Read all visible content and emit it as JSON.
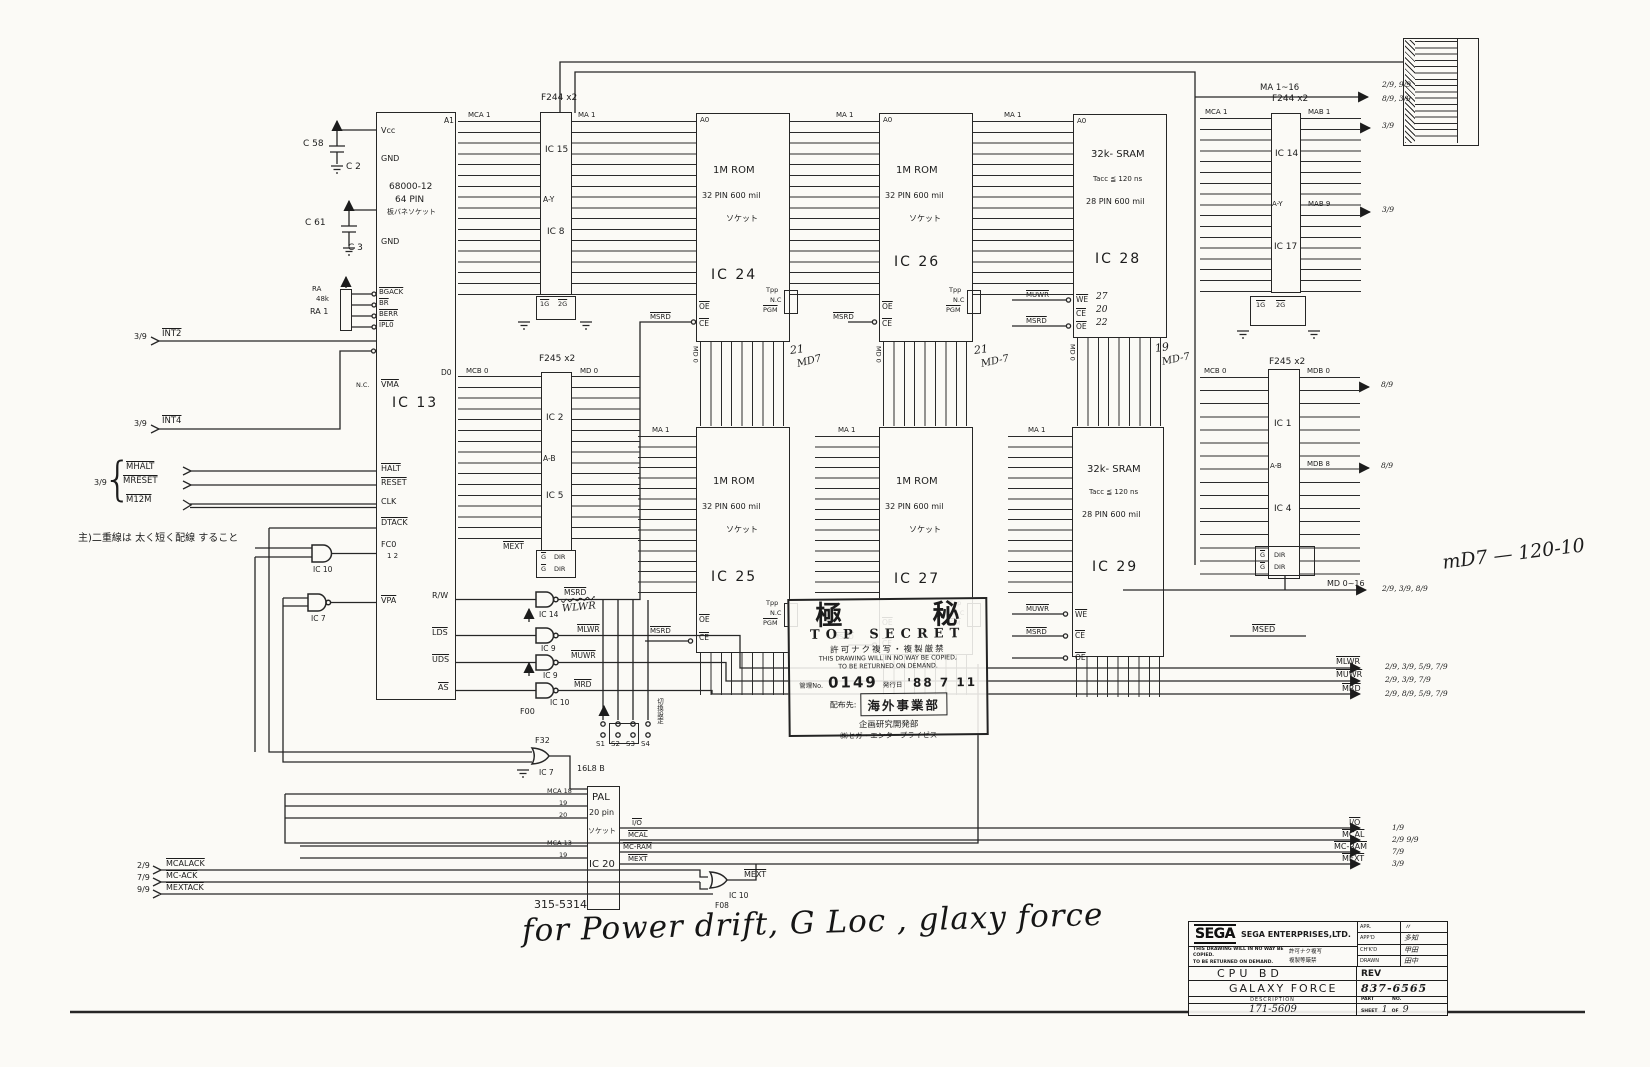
{
  "caps": {
    "c58": "C 58",
    "c2": "C 2",
    "c61": "C 61",
    "c3": "C 3"
  },
  "ra": {
    "name": "RA",
    "value": "48k",
    "ref": "RA 1"
  },
  "cpu": {
    "name": "IC 13",
    "part": "68000-12",
    "pins_label": "64 PIN",
    "socket": "板バネソケット",
    "a1": "A1",
    "d0": "D0",
    "vcc1": "Vcc",
    "gnd1": "GND",
    "vcc2": "Vcc",
    "gnd2": "GND",
    "bgack": "BGACK",
    "br": "BR",
    "berr": "BERR",
    "ipl": "IPL0",
    "nc": "N.C.",
    "vma": "VMA",
    "halt": "HALT",
    "reset": "RESET",
    "clk": "CLK",
    "dtack": "DTACK",
    "fc": "FC0",
    "fc_nums": "1   2",
    "vpa": "VPA",
    "rw": "R/W",
    "lds": "LDS",
    "uds": "UDS",
    "as": "AS"
  },
  "left": {
    "int2": {
      "ref": "3/9",
      "label": "INT2"
    },
    "int4": {
      "ref": "3/9",
      "label": "INT4"
    },
    "grp_ref": "3/9",
    "mhalt": "MHALT",
    "mreset": "MRESET",
    "m12m": "M12M",
    "note": "主)二重線は 太く短く配線 すること",
    "acks": [
      {
        "ref": "2/9",
        "label": "MCALACK"
      },
      {
        "ref": "7/9",
        "label": "MC-ACK"
      },
      {
        "ref": "9/9",
        "label": "MEXTACK"
      }
    ]
  },
  "buffers": {
    "f244l": {
      "title": "F244 x2",
      "ic_a": "IC 15",
      "mid": "A-Y",
      "ic_b": "IC 8",
      "hdr_in": "MCA 1",
      "hdr_out": "MA 1",
      "g1": "1G",
      "g2": "2G"
    },
    "f245l": {
      "title": "F245 x2",
      "ic_a": "IC 2",
      "mid": "A-B",
      "ic_b": "IC 5",
      "hdr_in": "MCB 0",
      "hdr_out": "MD 0",
      "mext": "MEXT",
      "g": "G",
      "dir": "DIR"
    },
    "f244r": {
      "title": "F244 x2",
      "ic_a": "IC 14",
      "mid": "A-Y",
      "ic_b": "IC 17",
      "hdr_in": "MCA 1",
      "hdr_out": "MAB 1",
      "hdr_out2": "MAB 9",
      "g1": "1G",
      "g2": "2G"
    },
    "f245r": {
      "title": "F245 x2",
      "ic_a": "IC 1",
      "mid": "A-B",
      "ic_b": "IC 4",
      "hdr_in": "MCB 0",
      "hdr_out": "MDB 0",
      "hdr_out2": "MDB 8",
      "g": "G",
      "dir": "DIR"
    }
  },
  "roms": {
    "l1": "1M ROM",
    "l2": "32 PIN 600 mil",
    "l3": "ソケット",
    "ma": "MA 1",
    "a0": "A0",
    "d0": "D0",
    "oe": "OE",
    "ce": "CE",
    "sel": "MSRD",
    "tpp": "Tpp",
    "nc": "N.C",
    "pgm": "PGM",
    "ic24": "IC 24",
    "ic25": "IC 25",
    "ic26": "IC 26",
    "ic27": "IC 27"
  },
  "srams": {
    "l1": "32k- SRAM",
    "l2": "Tacc ≦ 120 ns",
    "l3": "28 PIN 600 mil",
    "we": "WE",
    "ce": "CE",
    "oe": "OE",
    "we_sig": "MUWR",
    "oe_sig": "MSRD",
    "ic28": "IC 28",
    "ic29": "IC 29",
    "hand_we": "27",
    "hand_ce": "20",
    "hand_oe": "22"
  },
  "gates": {
    "fc_ic": "IC 10",
    "vpa_ic": "IC 7",
    "g1_ic": "IC 14",
    "g1_out": "MSRD",
    "g2_ic": "IC 9",
    "g2_out": "MLWR",
    "g3_ic": "IC 9",
    "g3_out": "MUWR",
    "g4_ic": "IC 10",
    "g4_out": "MRD",
    "family": "F00",
    "f32_family": "F32",
    "f32_ic": "IC 7",
    "mext_ic": "IC 10",
    "mext_family": "F08",
    "mext_out": "MEXT"
  },
  "jumpers": {
    "s1": "S1",
    "s2": "S2",
    "s3": "S3",
    "s4": "S4",
    "note": "切換設定"
  },
  "pal": {
    "l1": "PAL",
    "l2": "20 pin",
    "l3": "ソケット",
    "name": "IC 20",
    "family": "16L8 B",
    "part": "315-5314",
    "in1": "MCA 18",
    "in2": "19",
    "in3": "20",
    "in4": "MCA 13",
    "in5": "19",
    "out_io": "I/O",
    "out_mcal": "MCAL",
    "out_mcram": "MC-RAM",
    "out_mext": "MEXT"
  },
  "right": {
    "ma": {
      "label": "MA 1~16",
      "ref1": "2/9, 9/9",
      "ref2": "8/9, 3/9"
    },
    "mab1_ref": "3/9",
    "mab9_ref": "3/9",
    "mdb0_ref": "8/9",
    "mdb8_ref": "8/9",
    "md": {
      "label": "MD 0~16",
      "ref": "2/9, 3/9, 8/9"
    },
    "msed": "MSED",
    "mlwr": {
      "label": "MLWR",
      "ref": "2/9, 3/9, 5/9, 7/9"
    },
    "muwr": {
      "label": "MUWR",
      "ref": "2/9, 3/9, 7/9"
    },
    "mrd": {
      "label": "MRD",
      "ref": "2/9, 8/9, 5/9, 7/9"
    },
    "io": {
      "label": "I/O",
      "ref": "1/9"
    },
    "mcal": {
      "label": "MCAL",
      "ref": "2/9  9/9"
    },
    "mcram": {
      "label": "MC-RAM",
      "ref": "7/9"
    },
    "mext": {
      "label": "MEXT",
      "ref": "3/9"
    },
    "md7_note": "mD7 — 120-10"
  },
  "hand": {
    "wlwr": "WLWR",
    "md0": "MD 0",
    "a1": "21",
    "a2": "MD7",
    "b1": "21",
    "b2": "MD-7",
    "c1": "19",
    "c2": "MD-7"
  },
  "stamp": {
    "k1": "極",
    "k2": "秘",
    "en": "TOP SECRET",
    "jp1": "許可ナク複写・複製厳禁",
    "en1": "THIS DRAWING WILL IN NO WAY BE COPIED,",
    "en2": "TO BE RETURNED ON DEMAND.",
    "no_label": "管理No.",
    "no": "0149",
    "date_label": "発行日",
    "date": "'88 7 11",
    "dist_label": "配布先:",
    "dist": "海外事業部",
    "dept1": "企画研究開発部",
    "dept2": "㈱セガ・エンタープライゼス"
  },
  "titleblock": {
    "logo": "SEGA",
    "company": "SEGA ENTERPRISES,LTD.",
    "disc1": "THIS DRAWING WILL IN NO WAY BE COPIED.",
    "disc2": "TO BE RETURNED ON DEMAND.",
    "disc_jp1": "許可ナク複写",
    "disc_jp2": "複製等厳禁",
    "appr": [
      {
        "label": "APR.",
        "sign": "〃"
      },
      {
        "label": "APP'D",
        "sign": "多知"
      },
      {
        "label": "CH'K'D",
        "sign": "甲田"
      },
      {
        "label": "DRAWN",
        "sign": "田中"
      }
    ],
    "title": "CPU BD",
    "rev_label": "REV",
    "product": "GALAXY FORCE",
    "rev": "837-6565",
    "desc_label": "DESCRIPTION",
    "part_label": "PART",
    "no_label": "NO.",
    "desc": "171-5609",
    "sheet_label": "SHEET",
    "sheet_no": "1",
    "of_label": "OF",
    "sheet_total": "9"
  },
  "footer": {
    "script": "for Power drift, G Loc , glaxy force"
  }
}
